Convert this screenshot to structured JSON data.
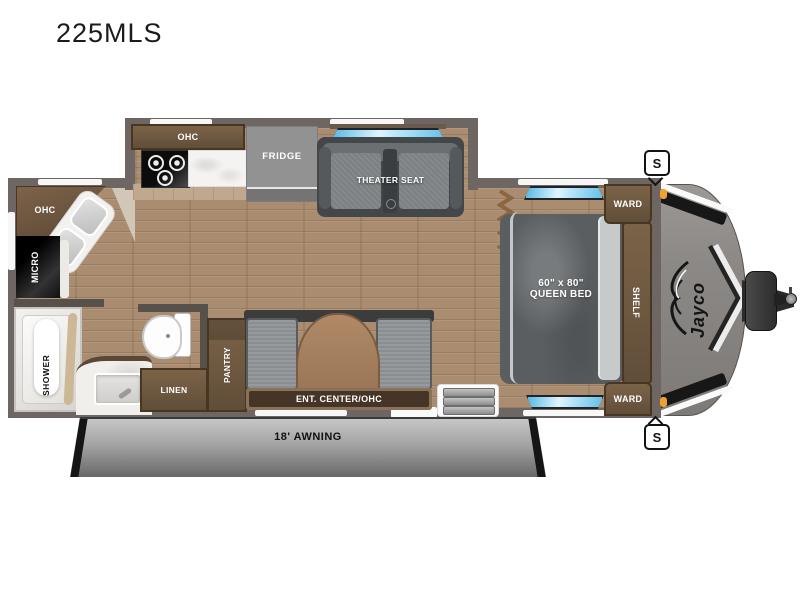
{
  "title": "225MLS",
  "kitchen": {
    "ohc": "OHC",
    "fridge": "FRIDGE"
  },
  "living": {
    "theater_seat": "THEATER SEAT",
    "ent_center": "ENT. CENTER/OHC",
    "pantry": "PANTRY"
  },
  "bath": {
    "ohc": "OHC",
    "micro": "MICRO",
    "shower": "SHOWER",
    "linen": "LINEN"
  },
  "bedroom": {
    "ward": "WARD",
    "shelf": "SHELF",
    "bed_size": "60\" x 80\"",
    "bed_type": "QUEEN BED"
  },
  "exterior": {
    "awning": "18' AWNING",
    "speaker": "S",
    "brand": "Jayco"
  },
  "colors": {
    "wall": "#6e6662",
    "floor": "#aa8d70",
    "cabinet": "#6f5942",
    "window_glass": "#7fd4f2",
    "marker_light": "#f0a030",
    "awning_gray": "#8f8f8f"
  }
}
